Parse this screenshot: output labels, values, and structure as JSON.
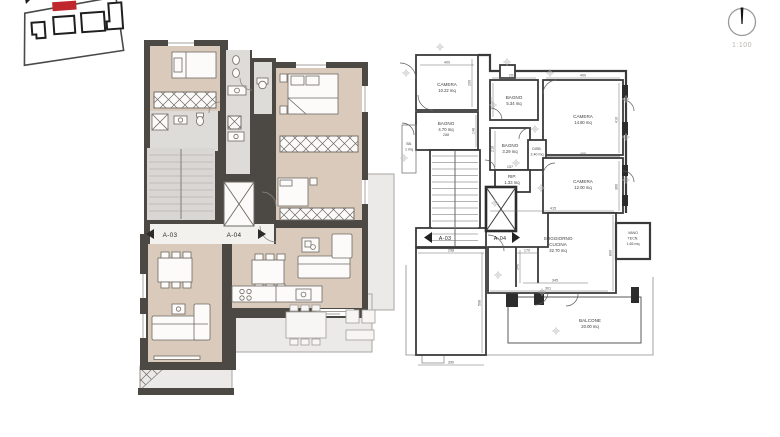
{
  "scale": {
    "label": "1:100"
  },
  "left_plan": {
    "unit_a": "A-03",
    "unit_b": "A-04"
  },
  "right_plan": {
    "unit_a": "A-03",
    "unit_b": "A-04",
    "rooms": {
      "camera1": {
        "name": "CAMERA",
        "area": "10.22 mq"
      },
      "bagno1": {
        "name": "BAGNO",
        "area": "5.34 mq"
      },
      "camera2": {
        "name": "CAMERA",
        "area": "14.80 mq"
      },
      "bagno2": {
        "name": "BAGNO",
        "area": "4.70 mq"
      },
      "bagno3": {
        "name": "BAGNO",
        "area": "3.29 mq"
      },
      "disb": {
        "name": "DISB.",
        "area": "2.40 mq"
      },
      "rip": {
        "name": "RIP.",
        "area": "1.33 mq"
      },
      "camera3": {
        "name": "CAMERA",
        "area": "12.00 mq"
      },
      "soggiorno": {
        "name": "SOGGIORNO",
        "name2": "CUCINA",
        "area": "32.70 mq"
      },
      "vano": {
        "name": "VANO",
        "name2": "TECN.",
        "area": "1.65 mq"
      },
      "balcone": {
        "name": "BALCONE",
        "area": "20.00 mq"
      },
      "sb": {
        "name": "SB.",
        "area": "1 mq"
      }
    },
    "dims": {
      "camera1_w": "400",
      "camera1_h": "200",
      "bagno1_w": "267",
      "bagno1_h": "200",
      "camera2_w": "400",
      "camera2_h": "410",
      "bagno2_h": "148",
      "bagno2_w": "288",
      "bagno3_h": "210",
      "bagno3_w": "157",
      "camera3_w": "400",
      "camera3_h": "360",
      "sogg_w": "415",
      "sogg_h": "800",
      "sogg_b": "301",
      "bl_top": "298",
      "corr_top": "170",
      "corr_h": "340",
      "kitchen_w": "345",
      "bl_h": "508",
      "bl_bottom": "390"
    }
  },
  "colors": {
    "wall": "#4c4945",
    "floor": "#d9cabb",
    "wet_floor": "#dedcd8",
    "balcony": "#eceae8",
    "line": "#3a3a3a",
    "accent_red": "#c0272d"
  }
}
